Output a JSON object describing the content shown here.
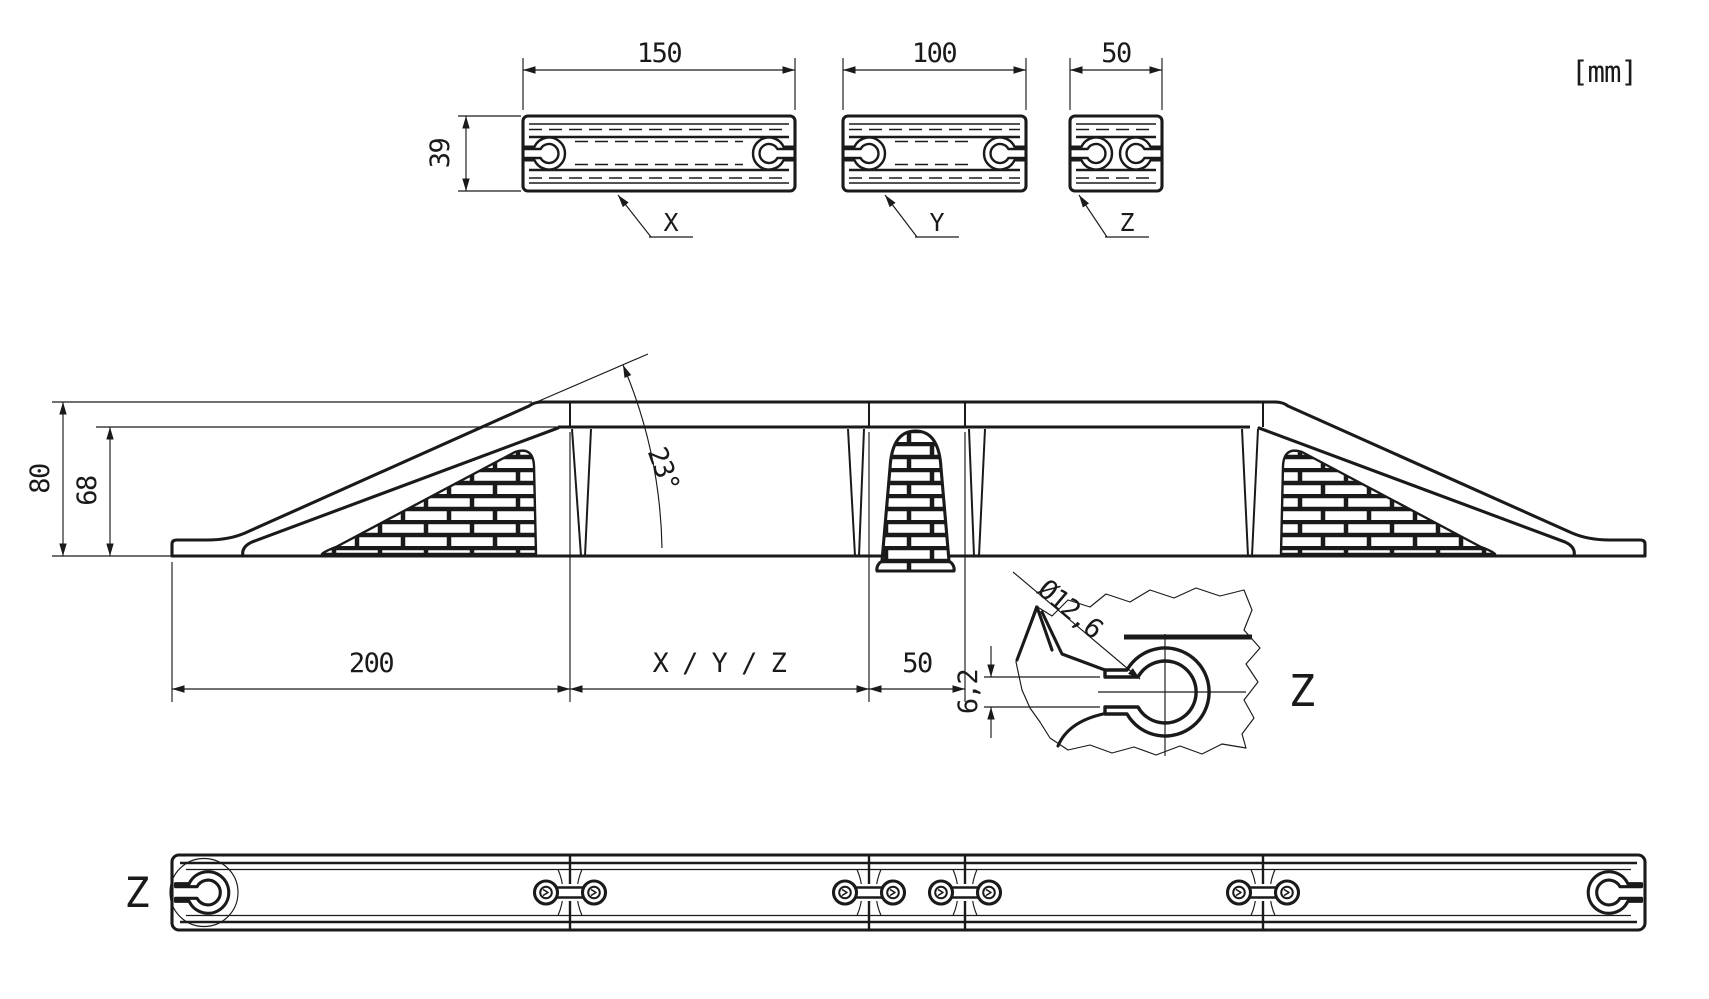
{
  "drawing": {
    "units_note": "[mm]",
    "colors": {
      "ink": "#1a1a1a",
      "paper": "#ffffff"
    },
    "section_views": {
      "height_dim": "39",
      "x": {
        "width_dim": "150",
        "label": "X"
      },
      "y": {
        "width_dim": "100",
        "label": "Y"
      },
      "z": {
        "width_dim": "50",
        "label": "Z"
      }
    },
    "elevation_view": {
      "overall_height_dim": "80",
      "clearance_height_dim": "68",
      "ramp_angle_dim": "23°",
      "end_module_length_dim": "200",
      "middle_module_length_dim": "X / Y / Z",
      "center_module_length_dim": "50"
    },
    "detail_view": {
      "label": "Z",
      "hole_diameter_dim": "Ø12,6",
      "slot_height_dim": "6,2"
    },
    "plan_view": {
      "detail_marker_label": "Z"
    }
  }
}
